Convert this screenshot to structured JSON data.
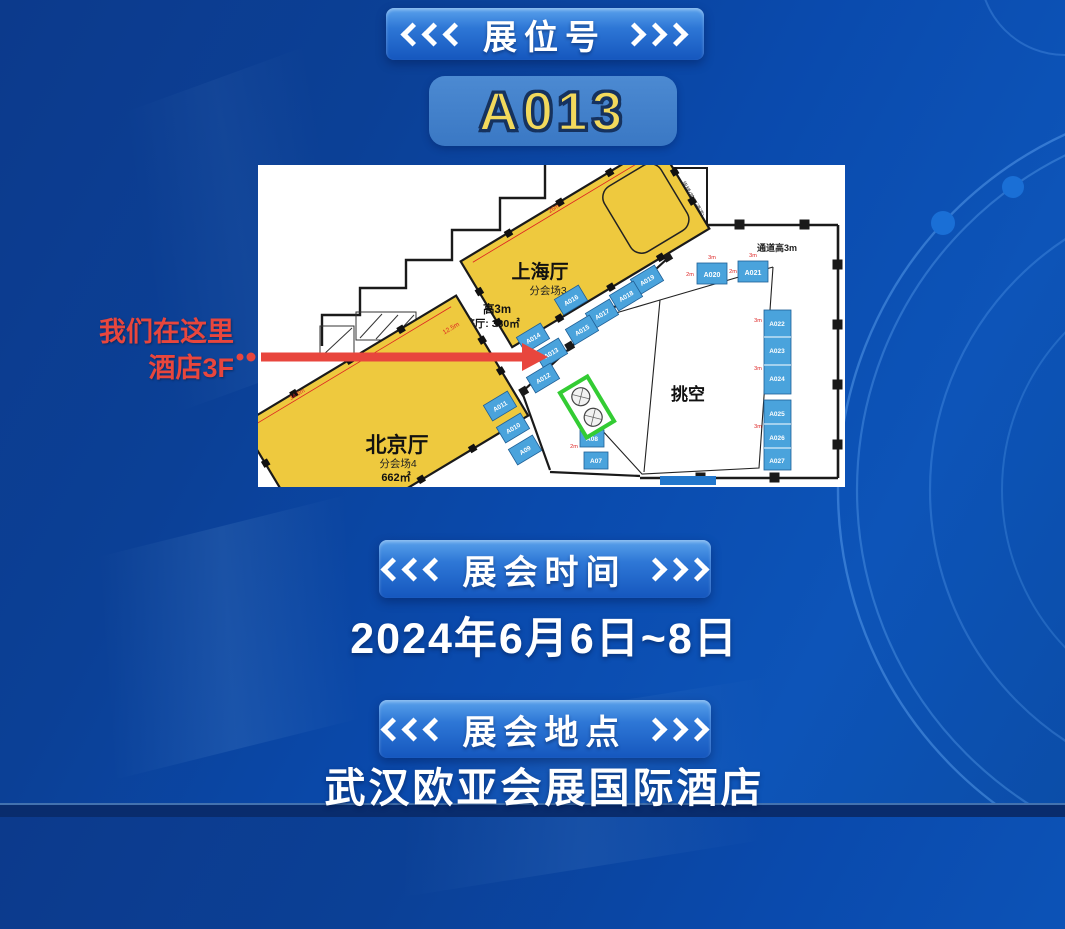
{
  "header": {
    "section_label": "展位号",
    "booth_number": "A013"
  },
  "callout": {
    "line1": "我们在这里",
    "line2": "酒店3F"
  },
  "sections": {
    "time": {
      "label": "展会时间",
      "value": "2024年6月6日~8日"
    },
    "location": {
      "label": "展会地点",
      "value": "武汉欧亚会展国际酒店"
    }
  },
  "map": {
    "shanghai": {
      "name": "上海厅",
      "subtitle": "分会场3",
      "height_note": "高3m",
      "area_note": "整厅: 330㎡",
      "dim": "26m"
    },
    "beijing": {
      "name": "北京厅",
      "subtitle": "分会场4",
      "area": "662㎡",
      "dim": "34.5m"
    },
    "atrium_label": "挑空",
    "aisle_note": "通道高3m",
    "corridor_dim": "12.5m",
    "stair_label": "货梯(施工通道)",
    "booths": {
      "diagonal": [
        "A019",
        "A018",
        "A017",
        "A016",
        "A015",
        "A014",
        "A013",
        "A012"
      ],
      "left": [
        "A011",
        "A010",
        "A09"
      ],
      "bottom": [
        "A08",
        "A07"
      ],
      "top": [
        "A020",
        "A021"
      ],
      "right": [
        "A022",
        "A023",
        "A024",
        "A025",
        "A026",
        "A027"
      ]
    },
    "small_dims": [
      "3m",
      "3m",
      "2m",
      "2m",
      "3m",
      "3m",
      "3m",
      "2m"
    ]
  },
  "colors": {
    "accent_red": "#e8463d",
    "hall_yellow": "#eec93e",
    "booth_blue": "#4aa3dc",
    "number_yellow": "#f2d95c",
    "escalator_green": "#33cc33"
  }
}
